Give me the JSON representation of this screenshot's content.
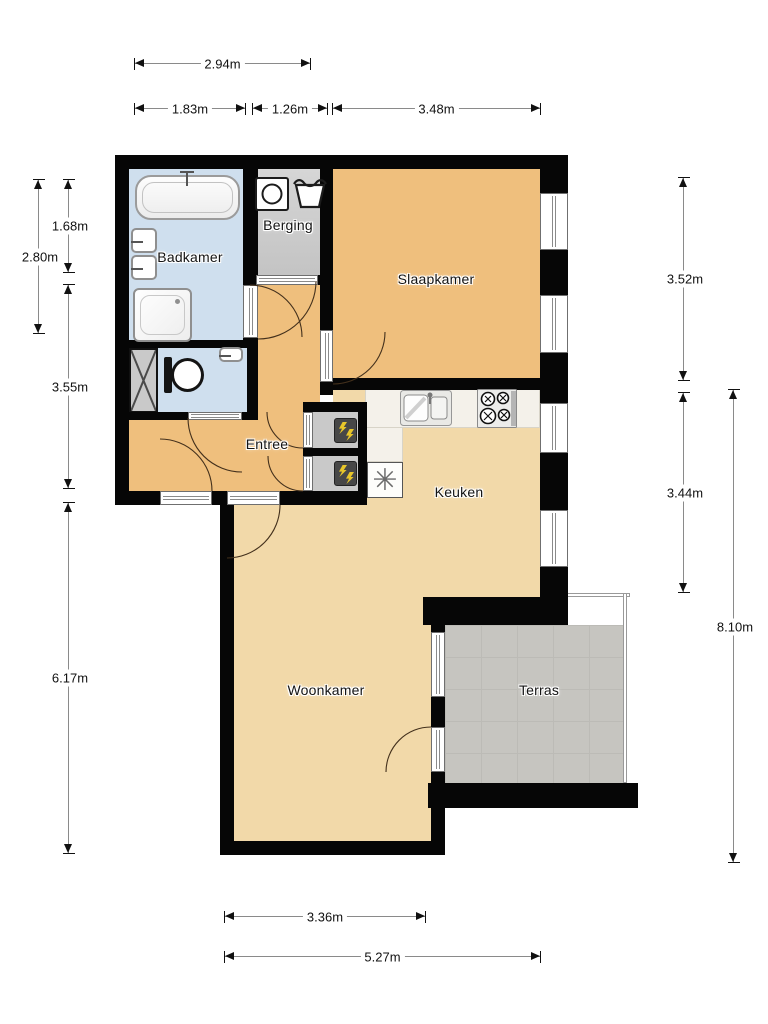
{
  "plan": {
    "title": "floor-plan",
    "rooms": [
      {
        "label": "Badkamer"
      },
      {
        "label": "Berging"
      },
      {
        "label": "Slaapkamer"
      },
      {
        "label": "Entree"
      },
      {
        "label": "Keuken"
      },
      {
        "label": "Woonkamer"
      },
      {
        "label": "Terras"
      }
    ],
    "icons": {
      "ventilation_symbol": "✳"
    },
    "dimensions": {
      "top": [
        {
          "label": "2.94m"
        },
        {
          "label": "1.83m"
        },
        {
          "label": "1.26m"
        },
        {
          "label": "3.48m"
        }
      ],
      "left": [
        {
          "label": "2.80m"
        },
        {
          "label": "1.68m"
        },
        {
          "label": "3.55m"
        },
        {
          "label": "6.17m"
        }
      ],
      "right": [
        {
          "label": "3.52m"
        },
        {
          "label": "3.44m"
        },
        {
          "label": "8.10m"
        }
      ],
      "bottom": [
        {
          "label": "3.36m"
        },
        {
          "label": "5.27m"
        }
      ]
    },
    "colors": {
      "wall": "#060606",
      "hall_bedroom_floor": "#efbf7d",
      "kitchen_living_floor": "#f2d9a9",
      "bathroom_floor": "#cfdfee",
      "storage_floor": "#cccccc",
      "terrace_floor": "#c6c5c0",
      "counter": "#f4f1ea"
    }
  }
}
